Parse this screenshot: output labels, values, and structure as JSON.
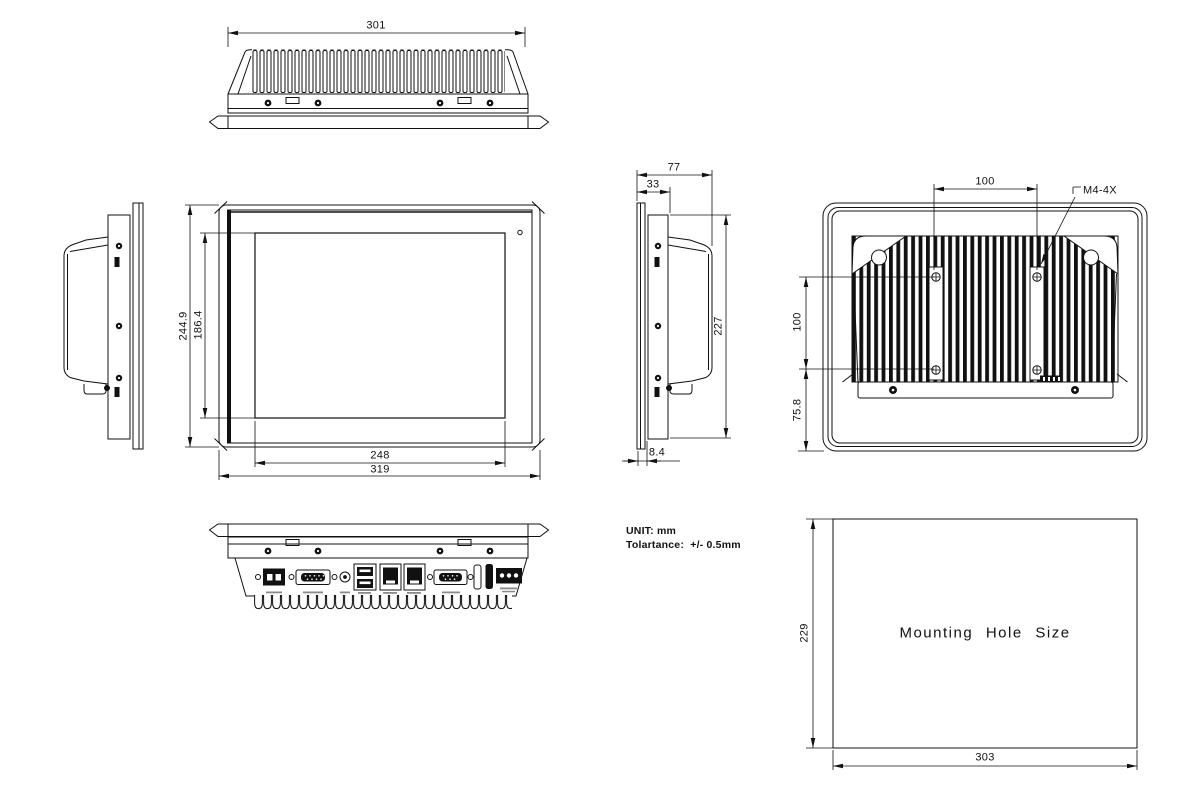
{
  "colors": {
    "line": "#111111",
    "background": "#ffffff"
  },
  "views": {
    "top": {
      "name": "top-view",
      "dim_width": "301"
    },
    "front": {
      "name": "front-view",
      "dim_outer_height": "244.9",
      "dim_screen_height": "186.4",
      "dim_screen_width": "248",
      "dim_outer_width": "319"
    },
    "side_left": {
      "name": "side-view-left"
    },
    "side_right": {
      "name": "side-view-right",
      "dim_total_depth": "77",
      "dim_front_depth": "33",
      "dim_body_height": "227",
      "dim_bezel_depth": "8.4"
    },
    "rear": {
      "name": "rear-view",
      "dim_vesa_width": "100",
      "dim_vesa_height": "100",
      "dim_bottom_offset": "75.8",
      "thread_label": "M4-4X"
    },
    "bottom": {
      "name": "bottom-view",
      "ports": [
        "screw",
        "power-terminal-2pin",
        "screw",
        "com-port-db9",
        "screw",
        "dc-jack",
        "usb-dual-port",
        "lan-port",
        "lan-port",
        "screw",
        "com-port-db9",
        "screw",
        "slot",
        "slot",
        "power-terminal-3pin"
      ]
    },
    "mounting": {
      "title": "Mounting Hole Size",
      "dim_height": "229",
      "dim_width": "303"
    }
  },
  "notes": {
    "unit": "UNIT: mm",
    "tolerance": "Tolartance:  +/- 0.5mm"
  }
}
